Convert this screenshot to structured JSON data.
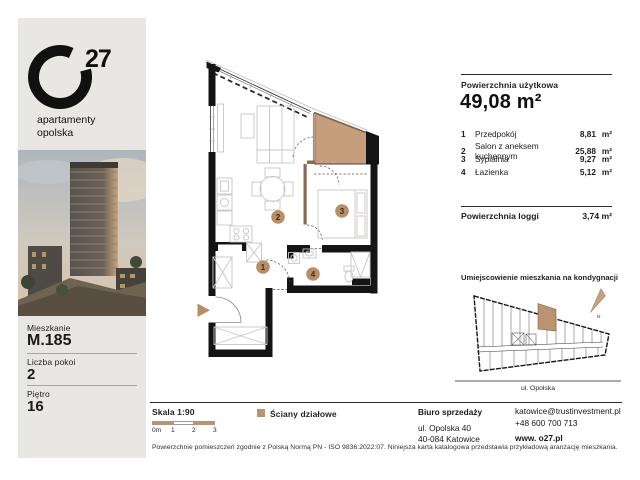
{
  "brand": {
    "logo_number": "27",
    "name_line1": "apartamenty",
    "name_line2": "opolska"
  },
  "sidebar": {
    "apartment_label": "Mieszkanie",
    "apartment_value": "M.185",
    "rooms_label": "Liczba pokoi",
    "rooms_value": "2",
    "floor_label": "Piętro",
    "floor_value": "16"
  },
  "summary": {
    "usable_area_label": "Powierzchnia użytkowa",
    "usable_area_value": "49,08 m²",
    "rooms": [
      {
        "num": "1",
        "name": "Przedpokój",
        "area": "8,81",
        "unit": "m²"
      },
      {
        "num": "2",
        "name": "Salon z aneksem kuchennym",
        "area": "25,88",
        "unit": "m²"
      },
      {
        "num": "3",
        "name": "Sypialnia",
        "area": "9,27",
        "unit": "m²"
      },
      {
        "num": "4",
        "name": "Łazienka",
        "area": "5,12",
        "unit": "m²"
      }
    ],
    "loggia_label": "Powierzchnia loggi",
    "loggia_value": "3,74 m²"
  },
  "location": {
    "title": "Umiejscowienie mieszkania na kondygnacji",
    "street": "ul. Opolska",
    "north_label": "N"
  },
  "plan": {
    "badges": [
      "1",
      "2",
      "3",
      "4"
    ]
  },
  "footerbar": {
    "scale_label": "Skala 1:90",
    "scale_ticks": [
      "0m",
      "1",
      "2",
      "3"
    ],
    "legend_partition": "Ściany działowe",
    "office_title": "Biuro sprzedaży",
    "office_line1": "ul. Opolska 40",
    "office_line2": "40-084 Katowice",
    "contact_email": "katowice@trustinvestment.pl",
    "contact_phone": "+48 600 700 713",
    "contact_web": "www. o27.pl",
    "disclaimer": "Powierzchnie pomieszczeń zgodnie z Polską Normą PN - ISO 9836:2022:07. Niniejsza karta katalogowa przedstawia przykładową aranżację mieszkania."
  },
  "colors": {
    "accent": "#BC9370",
    "wall": "#141414",
    "panel_gray": "#E8E7E4"
  }
}
